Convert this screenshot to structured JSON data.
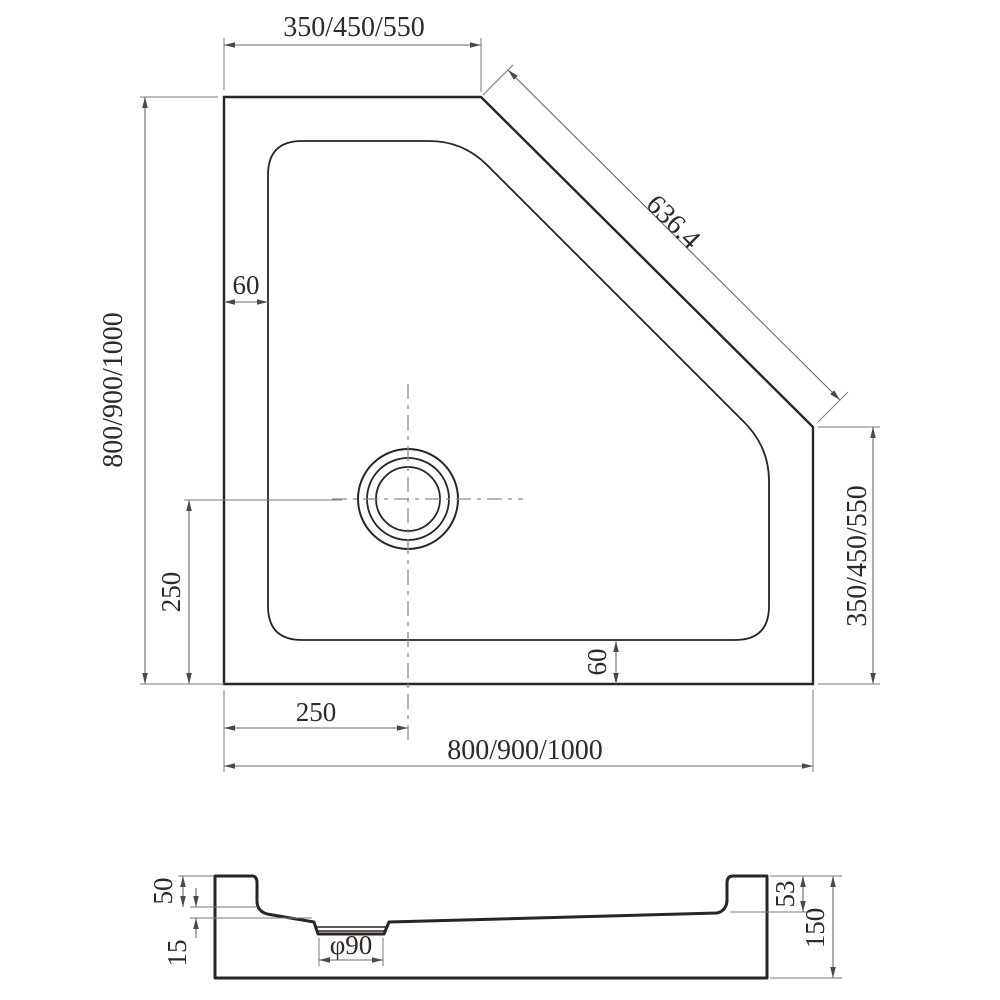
{
  "drawing": {
    "type": "technical-drawing",
    "subject": "corner shower tray with diagonal front edge, plan view and cross-section"
  },
  "colors": {
    "background": "#ffffff",
    "outline": "#2b2420",
    "dimension_lines": "#6a6a6a",
    "dimension_text": "#2e2a26"
  },
  "plan_view": {
    "dims": {
      "top_edge": "350/450/550",
      "diagonal_edge": "636.4",
      "left_edge": "800/900/1000",
      "right_edge": "350/450/550",
      "bottom_edge": "800/900/1000",
      "rim_offset_top_left": "60",
      "rim_offset_bottom_right": "60",
      "drain_offset_from_left": "250",
      "drain_offset_from_bottom": "250"
    }
  },
  "section_view": {
    "dims": {
      "left_rim_height": "50",
      "floor_recess_depth": "15",
      "drain_diameter": "φ90",
      "right_rim_height": "53",
      "overall_height": "150"
    }
  }
}
